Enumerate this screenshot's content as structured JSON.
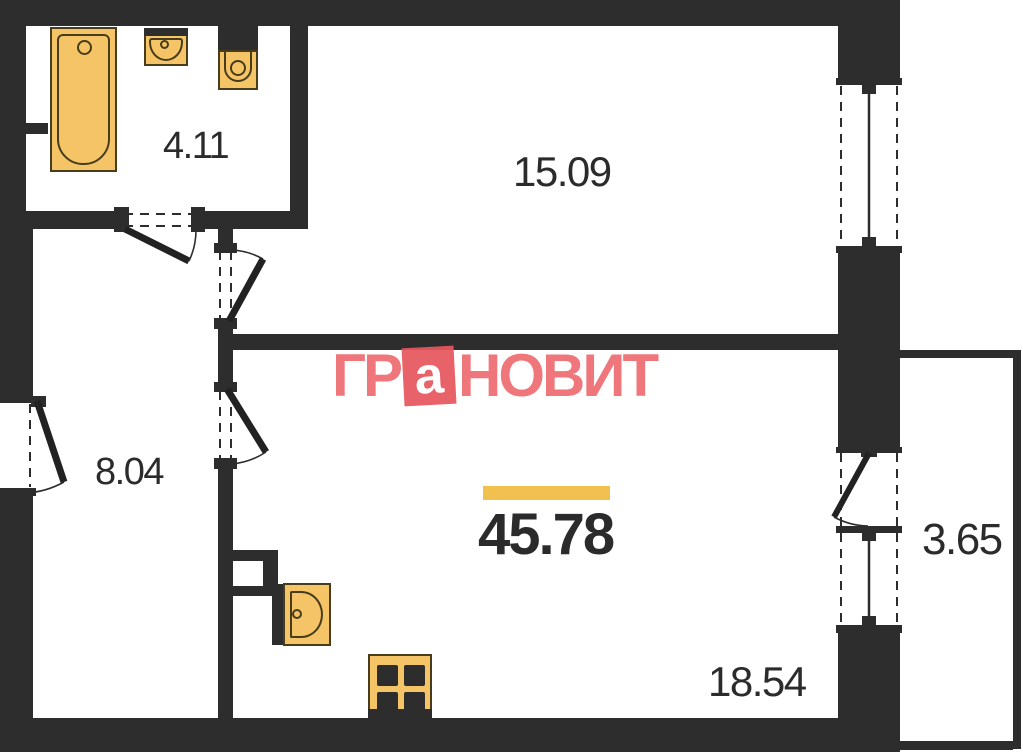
{
  "plan": {
    "watermark": {
      "prefix": "ГР",
      "boxed_letter": "а",
      "suffix": "НОВИТ"
    },
    "total_area": "45.78",
    "room_areas": {
      "bathroom": "4.11",
      "room_top": "15.09",
      "hallway": "8.04",
      "room_main": "18.54",
      "balcony": "3.65"
    },
    "colors": {
      "wall": "#2d2d2d",
      "fixture_fill": "#f5c467",
      "fixture_border": "#473d1c",
      "accent_bar": "#f1c04f",
      "watermark_text": "#ee6c70",
      "watermark_box": "#e7585e",
      "label_text": "#2b2b2b"
    },
    "fixtures": [
      "bathtub",
      "washbasin",
      "toilet",
      "kitchen-sink",
      "stove"
    ]
  }
}
